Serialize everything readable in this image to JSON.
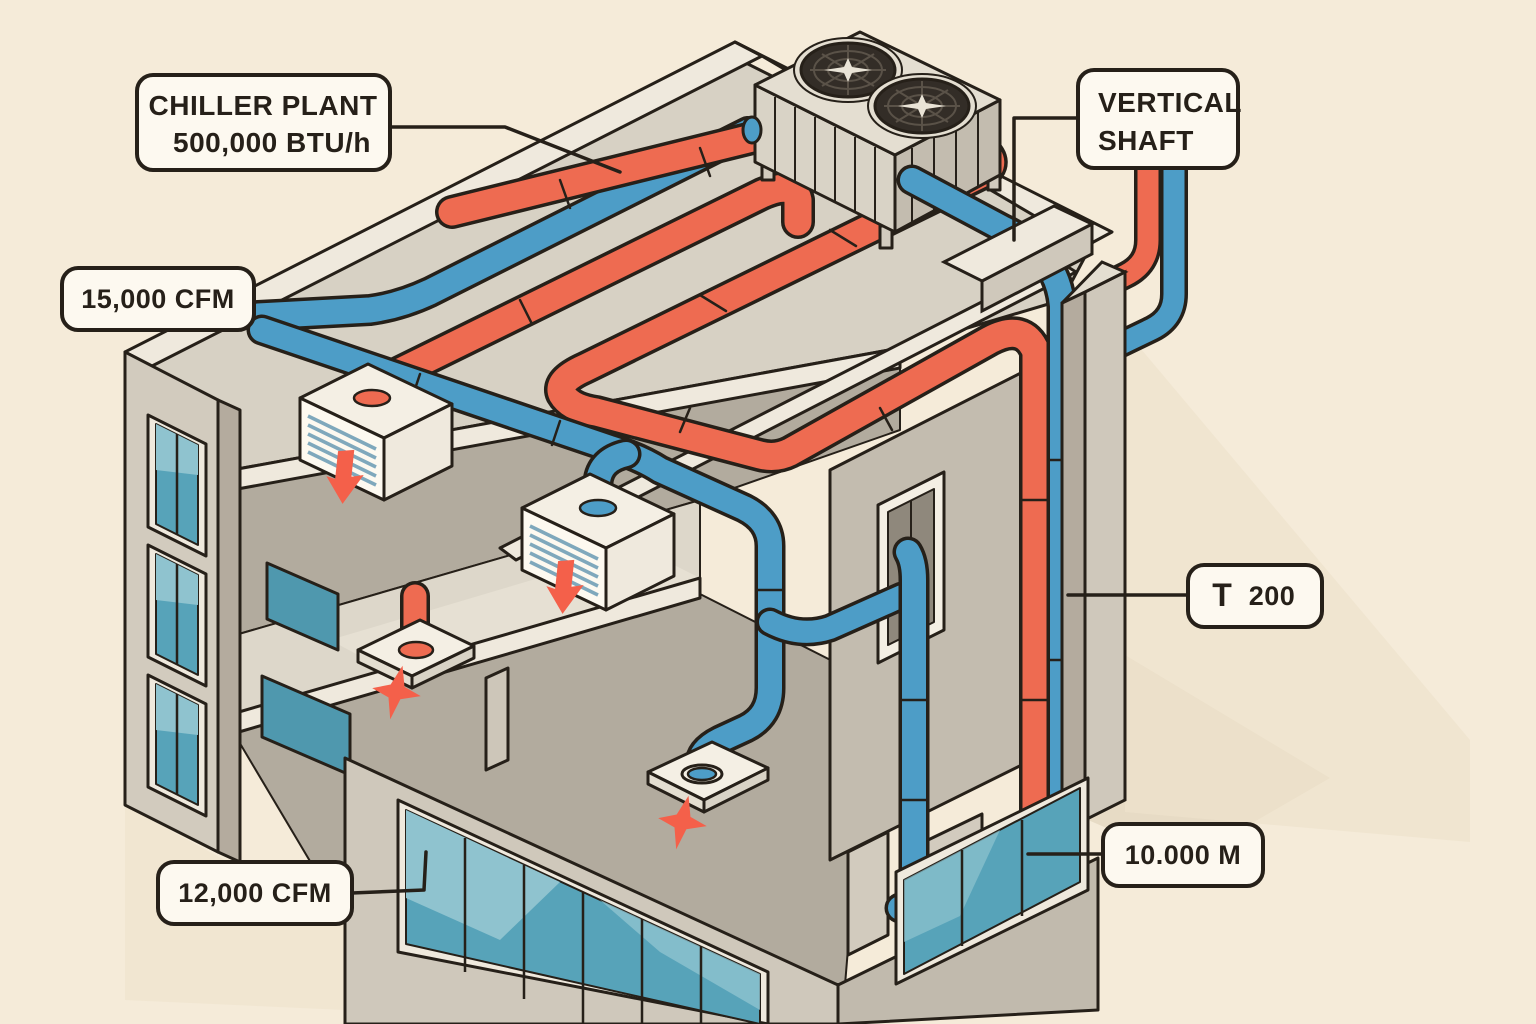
{
  "diagram": {
    "type": "isometric-building-hvac-cutaway",
    "description": "Three-story building cutaway with rooftop chiller, red supply and blue return piping, vertical shaft and ceiling diffusers",
    "labels": {
      "chiller_line1": "CHILLER PLANT",
      "chiller_line2": "500,000 BTU/h",
      "shaft_line1": "VERTICAL",
      "shaft_line2": "SHAFT",
      "cfm_supply": "15,000 CFM",
      "t_icon": "T",
      "t_value": "200",
      "meters": "10.000 M",
      "cfm_return": "12,000 CFM"
    },
    "components": [
      "rooftop-chiller-unit-with-two-fans",
      "red-supply-pipe-serpentine",
      "blue-return-duct-network",
      "vertical-shaft-pipes",
      "ceiling-diffusers",
      "airflow-arrows",
      "three-story-cutaway-building"
    ],
    "colors": {
      "background": "#f5ebd9",
      "roof_gray": "#d7d1c4",
      "wall_light": "#d2cbbe",
      "wall_mid": "#b9b2a5",
      "wall_dark": "#a9a295",
      "band_white": "#efe9dd",
      "outline": "#262019",
      "pipe_red": "#ee6b51",
      "pipe_blue": "#4d9dc7",
      "glass_teal": "#57a3b9",
      "glass_light": "#8fc3cf",
      "label_bg": "#fdf9f0",
      "arrow_red": "#f4604a",
      "fan_dark": "#332d27"
    }
  }
}
